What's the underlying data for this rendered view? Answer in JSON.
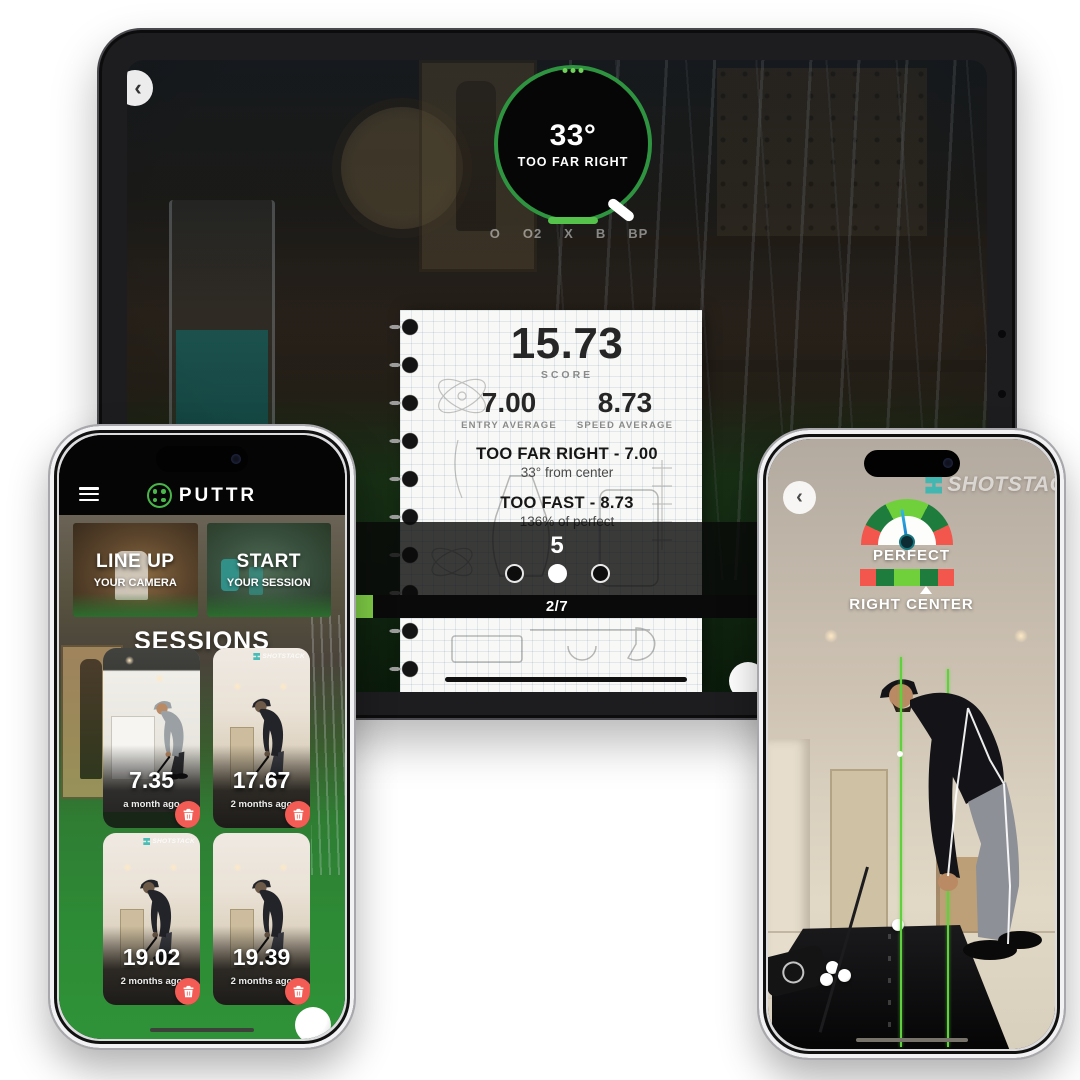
{
  "colors": {
    "accent_green": "#49b649",
    "bright_green": "#7ecb45",
    "gauge_dark_green": "#1e7d3c",
    "gauge_light_green": "#6fd03c",
    "gauge_red": "#f2564d",
    "delete_red": "#f25c54",
    "needle_blue": "#1f8fe8",
    "watermark_teal": "#35b8b2"
  },
  "ipad": {
    "back_icon": "‹",
    "dial": {
      "value": "33°",
      "label": "TOO FAR RIGHT"
    },
    "legend": [
      "O",
      "O2",
      "X",
      "B",
      "BP"
    ],
    "notebook": {
      "score": "15.73",
      "score_label": "SCORE",
      "entry_value": "7.00",
      "entry_label": "ENTRY AVERAGE",
      "speed_value": "8.73",
      "speed_label": "SPEED AVERAGE",
      "detail1_title": "TOO FAR RIGHT - 7.00",
      "detail1_sub": "33° from center",
      "detail2_title": "TOO FAST - 8.73",
      "detail2_sub": "136% of perfect"
    },
    "shot_number": "5",
    "progress_label": "2/7"
  },
  "left_phone": {
    "brand": "PUTTR",
    "actions": [
      {
        "title": "LINE UP",
        "subtitle": "YOUR CAMERA"
      },
      {
        "title": "START",
        "subtitle": "YOUR SESSION"
      }
    ],
    "sessions_title": "SESSIONS",
    "sessions": [
      {
        "score": "7.35",
        "age": "a month ago"
      },
      {
        "score": "17.67",
        "age": "2 months ago",
        "watermark": "SHOTSTACK"
      },
      {
        "score": "19.02",
        "age": "2 months ago",
        "watermark": "SHOTSTACK"
      },
      {
        "score": "19.39",
        "age": "2 months ago"
      }
    ]
  },
  "right_phone": {
    "back_icon": "‹",
    "watermark": "SHOTSTACK",
    "gauge_label": "PERFECT",
    "direction_label": "RIGHT CENTER"
  }
}
